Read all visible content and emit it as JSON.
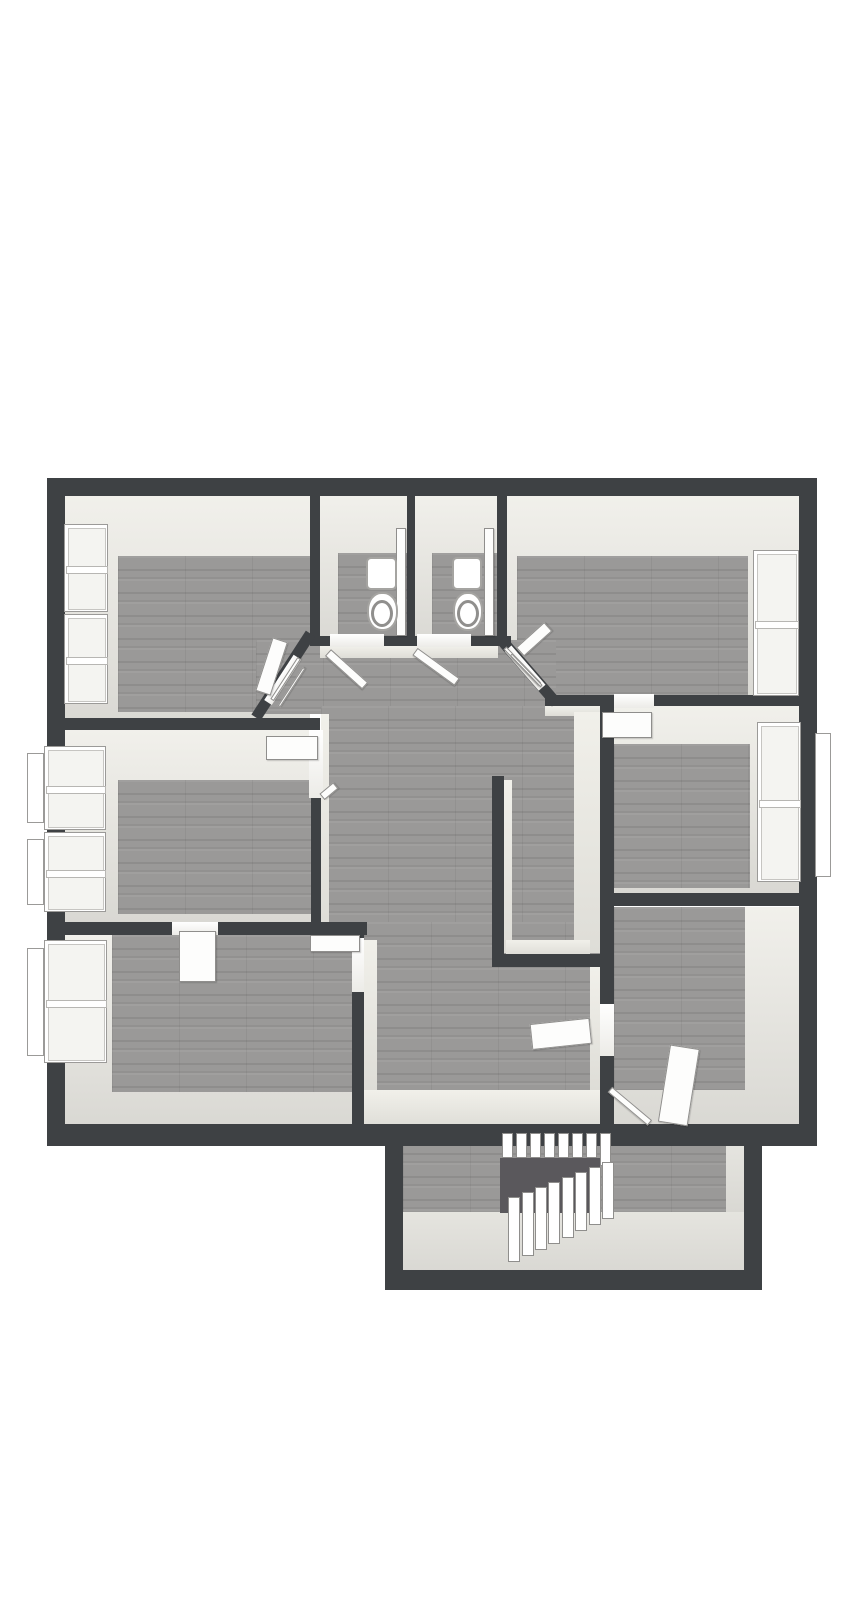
{
  "meta": {
    "description": "3D rendered architectural floor plan (top-down dollhouse view) of an upper storey with seven rooms, two WCs, a central hallway and a winder staircase extension at the bottom; no visible text labels",
    "background": "#ffffff"
  },
  "palette": {
    "wall": "#3e4144",
    "wood_floor": "#9a9998",
    "wall_face_light": "#e9e8e3",
    "white_fixture": "#ffffff",
    "stair_void": "#5a585c",
    "extension_floor_light": "#deddd8",
    "window_glass": "#f4f4f1"
  },
  "rooms": [
    {
      "name": "room-top-left",
      "windows": 2,
      "doors": 1
    },
    {
      "name": "wc-left",
      "windows": 0,
      "doors": 1,
      "fixtures": [
        "toilet"
      ]
    },
    {
      "name": "wc-right",
      "windows": 0,
      "doors": 1,
      "fixtures": [
        "toilet"
      ]
    },
    {
      "name": "room-top-right",
      "windows": 1,
      "doors": 1
    },
    {
      "name": "room-mid-left",
      "windows": 2,
      "doors": 2
    },
    {
      "name": "room-mid-right",
      "windows": 1,
      "doors": 1
    },
    {
      "name": "room-bottom-left",
      "windows": 1,
      "doors": 2
    },
    {
      "name": "room-bottom-right",
      "windows": 0,
      "doors": 1
    },
    {
      "name": "hallway-central",
      "windows": 0,
      "doors": 8
    },
    {
      "name": "stair-hall-extension",
      "windows": 0,
      "stairs": true
    }
  ],
  "primitives": [
    {
      "name": "room-top-left-wall-face",
      "x": 65,
      "y": 496,
      "w": 245,
      "h": 234,
      "fill": "face"
    },
    {
      "name": "wc-left-wall-face",
      "x": 320,
      "y": 496,
      "w": 87,
      "h": 150,
      "fill": "face"
    },
    {
      "name": "wc-right-wall-face",
      "x": 415,
      "y": 496,
      "w": 82,
      "h": 150,
      "fill": "face"
    },
    {
      "name": "room-top-right-wall-face",
      "x": 507,
      "y": 496,
      "w": 292,
      "h": 210,
      "fill": "face"
    },
    {
      "name": "room-mid-left-wall-face",
      "x": 65,
      "y": 730,
      "w": 246,
      "h": 192,
      "fill": "face"
    },
    {
      "name": "room-mid-right-wall-face",
      "x": 602,
      "y": 706,
      "w": 197,
      "h": 187,
      "fill": "face"
    },
    {
      "name": "room-bottom-left-wall-face",
      "x": 65,
      "y": 935,
      "w": 287,
      "h": 193,
      "fill": "face"
    },
    {
      "name": "room-bottom-right-wall-face",
      "x": 614,
      "y": 907,
      "w": 185,
      "h": 221,
      "fill": "face"
    },
    {
      "name": "room-top-left-floor",
      "x": 118,
      "y": 556,
      "w": 192,
      "h": 156,
      "fill": "wood"
    },
    {
      "name": "wc-left-floor",
      "x": 338,
      "y": 553,
      "w": 69,
      "h": 87,
      "fill": "wood"
    },
    {
      "name": "wc-right-floor",
      "x": 432,
      "y": 553,
      "w": 65,
      "h": 87,
      "fill": "wood"
    },
    {
      "name": "room-top-right-floor",
      "x": 517,
      "y": 556,
      "w": 231,
      "h": 140,
      "fill": "wood"
    },
    {
      "name": "room-mid-left-floor",
      "x": 118,
      "y": 780,
      "w": 193,
      "h": 134,
      "fill": "wood"
    },
    {
      "name": "room-mid-right-floor",
      "x": 614,
      "y": 744,
      "w": 136,
      "h": 144,
      "fill": "wood"
    },
    {
      "name": "room-bottom-left-floor",
      "x": 112,
      "y": 935,
      "w": 240,
      "h": 157,
      "fill": "wood"
    },
    {
      "name": "room-bottom-right-floor",
      "x": 614,
      "y": 907,
      "w": 131,
      "h": 183,
      "fill": "wood"
    },
    {
      "name": "hallway-floor-top",
      "x": 256,
      "y": 640,
      "w": 300,
      "h": 74,
      "fill": "wood"
    },
    {
      "name": "hallway-floor-mid",
      "x": 321,
      "y": 706,
      "w": 281,
      "h": 229,
      "fill": "wood"
    },
    {
      "name": "hallway-floor-bottom",
      "x": 364,
      "y": 922,
      "w": 238,
      "h": 206,
      "fill": "wood"
    },
    {
      "name": "stair-hall-floor-wood",
      "x": 403,
      "y": 1140,
      "w": 323,
      "h": 72,
      "fill": "wood"
    },
    {
      "name": "stair-hall-floor-light",
      "x": 403,
      "y": 1212,
      "w": 341,
      "h": 60,
      "fill": "extlight"
    },
    {
      "name": "stair-hall-floor-light-right",
      "x": 726,
      "y": 1146,
      "w": 18,
      "h": 66,
      "fill": "extlight"
    },
    {
      "name": "hallway-face-below-wc",
      "x": 320,
      "y": 646,
      "w": 178,
      "h": 12,
      "fill": "strip"
    },
    {
      "name": "hallway-face-left-wall",
      "x": 321,
      "y": 714,
      "w": 8,
      "h": 218,
      "fill": "strip"
    },
    {
      "name": "hallway-face-below-topright",
      "x": 545,
      "y": 706,
      "w": 56,
      "h": 10,
      "fill": "strip"
    },
    {
      "name": "stair-shaft-west-face",
      "x": 574,
      "y": 712,
      "w": 28,
      "h": 241,
      "fill": "strip"
    },
    {
      "name": "stair-shaft-inner-left-face",
      "x": 504,
      "y": 780,
      "w": 8,
      "h": 173,
      "fill": "strip"
    },
    {
      "name": "stair-shaft-north-face",
      "x": 506,
      "y": 940,
      "w": 84,
      "h": 15,
      "fill": "strip"
    },
    {
      "name": "hallway-face-right-lower",
      "x": 590,
      "y": 967,
      "w": 12,
      "h": 123,
      "fill": "strip"
    },
    {
      "name": "hallway-face-bottomleft-wall",
      "x": 364,
      "y": 940,
      "w": 13,
      "h": 150,
      "fill": "strip"
    },
    {
      "name": "hallway-face-bottom",
      "x": 364,
      "y": 1090,
      "w": 238,
      "h": 38,
      "fill": "strip"
    },
    {
      "name": "outer-wall-top",
      "x": 47,
      "y": 478,
      "w": 770,
      "h": 18,
      "fill": "wall"
    },
    {
      "name": "outer-wall-left",
      "x": 47,
      "y": 478,
      "w": 18,
      "h": 668,
      "fill": "wall"
    },
    {
      "name": "outer-wall-right",
      "x": 799,
      "y": 478,
      "w": 18,
      "h": 668,
      "fill": "wall"
    },
    {
      "name": "wall-wc-left",
      "x": 310,
      "y": 494,
      "w": 10,
      "h": 152,
      "fill": "wall"
    },
    {
      "name": "wall-wc-mid",
      "x": 407,
      "y": 494,
      "w": 8,
      "h": 152,
      "fill": "wall"
    },
    {
      "name": "wall-wc-right",
      "x": 497,
      "y": 494,
      "w": 10,
      "h": 152,
      "fill": "wall"
    },
    {
      "name": "wall-wc-front",
      "x": 315,
      "y": 636,
      "w": 196,
      "h": 10,
      "fill": "wall"
    },
    {
      "name": "wall-hall-chamfer-left",
      "x": 256,
      "y": 712,
      "w": 100,
      "h": 11,
      "r": -57,
      "fill": "wall"
    },
    {
      "name": "wall-hall-chamfer-right",
      "x": 501,
      "y": 634,
      "w": 84,
      "h": 11,
      "r": 49,
      "fill": "wall"
    },
    {
      "name": "wall-topright-bottom",
      "x": 545,
      "y": 695,
      "w": 254,
      "h": 11,
      "fill": "wall"
    },
    {
      "name": "wall-midleft-top",
      "x": 47,
      "y": 718,
      "w": 273,
      "h": 12,
      "fill": "wall"
    },
    {
      "name": "wall-hall-left",
      "x": 311,
      "y": 798,
      "w": 10,
      "h": 137,
      "fill": "wall"
    },
    {
      "name": "wall-midleft-bottom",
      "x": 47,
      "y": 922,
      "w": 320,
      "h": 13,
      "fill": "wall"
    },
    {
      "name": "wall-bottomleft-right",
      "x": 352,
      "y": 922,
      "w": 12,
      "h": 206,
      "fill": "wall"
    },
    {
      "name": "wall-hall-right",
      "x": 600,
      "y": 706,
      "w": 14,
      "h": 422,
      "fill": "wall"
    },
    {
      "name": "wall-stair-shaft-left",
      "x": 492,
      "y": 776,
      "w": 12,
      "h": 191,
      "fill": "wall"
    },
    {
      "name": "wall-stair-shaft-bottom",
      "x": 492,
      "y": 954,
      "w": 122,
      "h": 13,
      "fill": "wall"
    },
    {
      "name": "wall-midright-bottom",
      "x": 600,
      "y": 893,
      "w": 199,
      "h": 13,
      "fill": "wall"
    },
    {
      "name": "outer-wall-bottom",
      "x": 47,
      "y": 1124,
      "w": 770,
      "h": 22,
      "fill": "wall"
    },
    {
      "name": "extension-wall-left",
      "x": 385,
      "y": 1128,
      "w": 18,
      "h": 162,
      "fill": "wall"
    },
    {
      "name": "extension-wall-right",
      "x": 744,
      "y": 1128,
      "w": 18,
      "h": 162,
      "fill": "wall"
    },
    {
      "name": "extension-wall-bottom",
      "x": 385,
      "y": 1270,
      "w": 377,
      "h": 20,
      "fill": "wall"
    },
    {
      "name": "doorway-wc-left",
      "x": 330,
      "y": 634,
      "w": 54,
      "h": 13,
      "fill": "opening"
    },
    {
      "name": "doorway-wc-right",
      "x": 417,
      "y": 634,
      "w": 54,
      "h": 13,
      "fill": "opening"
    },
    {
      "name": "doorway-room-top-left",
      "x": 268,
      "y": 698,
      "w": 54,
      "h": 9,
      "r": -57,
      "fill": "opening"
    },
    {
      "name": "doorway-room-top-right",
      "x": 508,
      "y": 644,
      "w": 52,
      "h": 9,
      "r": 49,
      "fill": "opening"
    },
    {
      "name": "doorway-room-mid-left",
      "x": 309,
      "y": 730,
      "w": 14,
      "h": 68,
      "fill": "opening"
    },
    {
      "name": "doorway-room-mid-right",
      "x": 614,
      "y": 694,
      "w": 40,
      "h": 14,
      "fill": "opening"
    },
    {
      "name": "doorway-bottom-left-top",
      "x": 172,
      "y": 922,
      "w": 46,
      "h": 13,
      "fill": "opening"
    },
    {
      "name": "doorway-bottom-left-side",
      "x": 352,
      "y": 938,
      "w": 12,
      "h": 54,
      "fill": "opening"
    },
    {
      "name": "doorway-bottom-right",
      "x": 600,
      "y": 1004,
      "w": 14,
      "h": 52,
      "fill": "opening"
    },
    {
      "name": "stair-void",
      "x": 500,
      "y": 1158,
      "w": 100,
      "h": 55,
      "fill": "void"
    }
  ],
  "doors": [
    {
      "name": "door-leaf-wc-left",
      "x": 328,
      "y": 648,
      "w": 50,
      "h": 9,
      "r": 42
    },
    {
      "name": "door-leaf-wc-right",
      "x": 415,
      "y": 647,
      "w": 52,
      "h": 9,
      "r": 36
    },
    {
      "name": "door-leaf-wc-left-inside",
      "x": 396,
      "y": 528,
      "w": 10,
      "h": 108,
      "r": 0
    },
    {
      "name": "door-leaf-wc-right-inside",
      "x": 484,
      "y": 528,
      "w": 10,
      "h": 108,
      "r": 0
    },
    {
      "name": "door-leaf-room-top-left",
      "x": 264,
      "y": 636,
      "w": 16,
      "h": 56,
      "r": 18
    },
    {
      "name": "door-frame-top-left-a",
      "x": 272,
      "y": 698,
      "w": 50,
      "h": 4,
      "r": -57
    },
    {
      "name": "door-frame-top-left-b",
      "x": 279,
      "y": 705,
      "w": 46,
      "h": 3,
      "r": -57
    },
    {
      "name": "door-leaf-room-top-right",
      "x": 520,
      "y": 646,
      "w": 38,
      "h": 12,
      "r": -42
    },
    {
      "name": "door-frame-top-right-a",
      "x": 505,
      "y": 646,
      "w": 50,
      "h": 4,
      "r": 46
    },
    {
      "name": "door-frame-top-right-b",
      "x": 511,
      "y": 653,
      "w": 44,
      "h": 3,
      "r": 46
    },
    {
      "name": "door-leaf-room-mid-left",
      "x": 266,
      "y": 736,
      "w": 52,
      "h": 24,
      "r": 0
    },
    {
      "name": "door-jamb-mid-left",
      "x": 322,
      "y": 793,
      "w": 18,
      "h": 8,
      "r": -40
    },
    {
      "name": "door-leaf-room-mid-right",
      "x": 602,
      "y": 712,
      "w": 50,
      "h": 26,
      "r": 0
    },
    {
      "name": "door-leaf-bottom-left-inner",
      "x": 179,
      "y": 931,
      "w": 37,
      "h": 51,
      "r": 0
    },
    {
      "name": "door-leaf-bottom-left-hall",
      "x": 310,
      "y": 935,
      "w": 50,
      "h": 17,
      "r": 0
    },
    {
      "name": "door-leaf-bottom-right-hall",
      "x": 531,
      "y": 1024,
      "w": 60,
      "h": 26,
      "r": -6
    },
    {
      "name": "door-leaf-room-bottom-right",
      "x": 664,
      "y": 1044,
      "w": 30,
      "h": 78,
      "r": 9
    },
    {
      "name": "door-frame-bottom-right",
      "x": 610,
      "y": 1086,
      "w": 52,
      "h": 7,
      "r": 40
    }
  ],
  "windows": [
    {
      "name": "window-top-left-1",
      "x": 64,
      "y": 524,
      "w": 44,
      "h": 88,
      "sashes": 2
    },
    {
      "name": "window-top-left-2",
      "x": 64,
      "y": 614,
      "w": 44,
      "h": 90,
      "sashes": 2
    },
    {
      "name": "window-mid-left-1",
      "x": 44,
      "y": 746,
      "w": 62,
      "h": 84,
      "sashes": 2,
      "outer": {
        "x": 27,
        "y": 753,
        "w": 17,
        "h": 70
      }
    },
    {
      "name": "window-mid-left-2",
      "x": 44,
      "y": 832,
      "w": 62,
      "h": 80,
      "sashes": 2,
      "outer": {
        "x": 27,
        "y": 839,
        "w": 17,
        "h": 66
      }
    },
    {
      "name": "window-bottom-left",
      "x": 44,
      "y": 940,
      "w": 63,
      "h": 123,
      "sashes": 2,
      "outer": {
        "x": 27,
        "y": 948,
        "w": 17,
        "h": 108
      }
    },
    {
      "name": "window-top-right",
      "x": 753,
      "y": 550,
      "w": 46,
      "h": 146,
      "sashes": 2
    },
    {
      "name": "window-mid-right",
      "x": 757,
      "y": 722,
      "w": 44,
      "h": 160,
      "sashes": 2,
      "outer": {
        "x": 815,
        "y": 733,
        "w": 16,
        "h": 144
      }
    }
  ],
  "toilets": [
    {
      "name": "toilet-wc-left",
      "tank": {
        "x": 366,
        "y": 557,
        "w": 31,
        "h": 33
      },
      "bowl": {
        "x": 367,
        "y": 592,
        "w": 31,
        "h": 39
      }
    },
    {
      "name": "toilet-wc-right",
      "tank": {
        "x": 452,
        "y": 557,
        "w": 30,
        "h": 33
      },
      "bowl": {
        "x": 453,
        "y": 592,
        "w": 30,
        "h": 39
      }
    }
  ],
  "stairs": {
    "top_steps": {
      "count": 8,
      "x0": 502,
      "dx": 14,
      "y": 1133,
      "w": 11,
      "h": 25
    },
    "winders": {
      "count": 8,
      "x0": 602,
      "dx": -13.4,
      "y0": 1162,
      "dy": 5,
      "w": 12,
      "h0": 57,
      "dh": 1.2
    }
  }
}
